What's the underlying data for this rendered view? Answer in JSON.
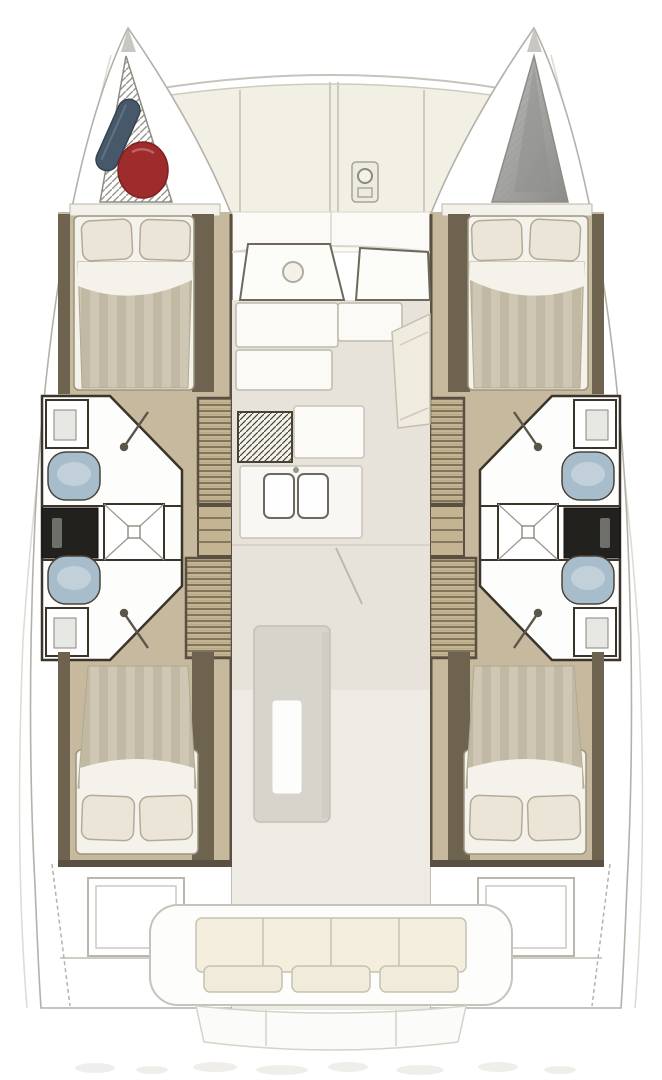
{
  "palette": {
    "page-bg": "#ffffff",
    "hull-outline": "#b4b1a9",
    "lifeline": "#dedcd6",
    "wall-dark": "#5a5042",
    "wood-dark": "#6e634f",
    "floor-wood": "#c7b99d",
    "stair-base": "#c4b491",
    "stair-line": "#6f6450",
    "bath-white": "#fdfdfc",
    "fixture-outline": "#3a342b",
    "toilet-blue": "#a8bdcb",
    "toilet-blue-light": "#c5d3dc",
    "vanity-black": "#23211e",
    "bed-sheet": "#f4f2ea",
    "duvet-a": "#cfc6b3",
    "duvet-b": "#c2b9a4",
    "pillow": "#eae5d7",
    "pillow-edge": "#b3ab9a",
    "deck-cream": "#f2efe4",
    "deck-line": "#cfcbbb",
    "salon-floor": "#e7e3da",
    "cockpit-floor": "#edebe4",
    "counter-line": "#c8c4b6",
    "furniture-white": "#fbfaf6",
    "bench-cushion": "#f3eedd",
    "bow-gray": "#a9a9a7",
    "bow-gray-dark": "#8b8b89",
    "fender-blue": "#47586a",
    "buoy-red": "#9e2c2c",
    "table-gray": "#d7d4cc",
    "smudge": "#d8d5cf",
    "outline-soft": "#c6c3ba"
  },
  "floorplan": {
    "drawing": "catamaran-interior-floorplan-top-view",
    "hulls": [
      {
        "side": "port",
        "sections": [
          "bow-locker",
          "forward-cabin-double-bed",
          "forward-head-with-sink-and-toilet",
          "midship-vanity-and-shower",
          "aft-head-with-toilet-and-sink",
          "companionway-stairs",
          "aft-cabin-double-bed",
          "transom-steps"
        ],
        "bow_locker_contents": [
          "blue-fender",
          "red-buoy"
        ]
      },
      {
        "side": "starboard",
        "sections": [
          "bow-locker",
          "forward-cabin-double-bed",
          "forward-head-with-sink-and-toilet",
          "midship-vanity-and-shower",
          "aft-head-with-toilet-and-sink",
          "companionway-stairs",
          "aft-cabin-double-bed",
          "transom-steps"
        ],
        "bow_locker_contents": []
      }
    ],
    "center_sections": [
      "foredeck-panels",
      "anchor-windlass",
      "forward-watch-seats",
      "salon-settee",
      "chart-seat",
      "galley-stove",
      "galley-double-sink",
      "dining-table",
      "aft-cockpit-bench",
      "swim-platform"
    ],
    "counts": {
      "cabins": 4,
      "toilets": 4,
      "showers": 2,
      "double_beds": 4
    }
  }
}
